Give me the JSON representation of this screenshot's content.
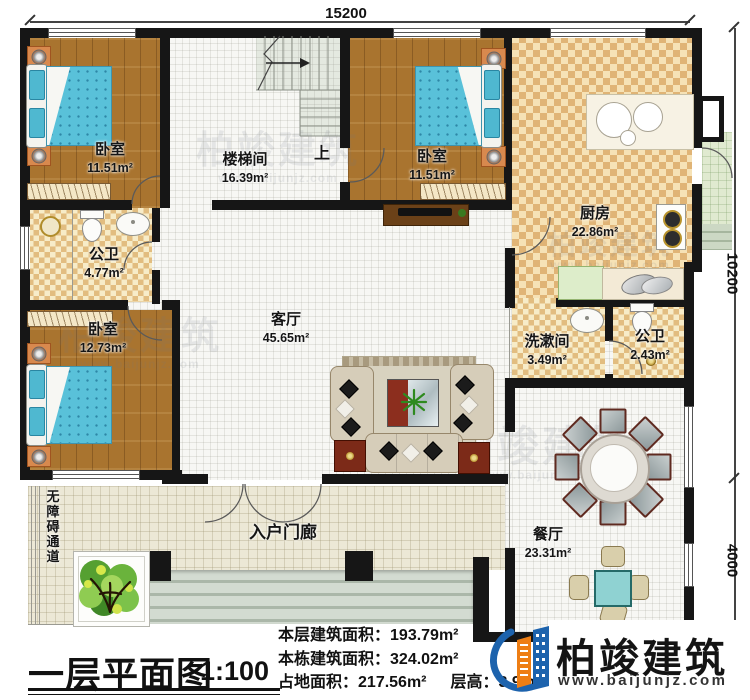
{
  "plan": {
    "title": "一层平面图",
    "scale": "1:100",
    "dims": {
      "top": "15200",
      "right_upper": "10200",
      "right_lower": "4000"
    },
    "labels": {
      "up": "上"
    }
  },
  "rooms": [
    {
      "name": "卧室",
      "area": "11.51m²"
    },
    {
      "name": "楼梯间",
      "area": "16.39m²"
    },
    {
      "name": "卧室",
      "area": "11.51m²"
    },
    {
      "name": "厨房",
      "area": "22.86m²"
    },
    {
      "name": "公卫",
      "area": "4.77m²"
    },
    {
      "name": "卧室",
      "area": "12.73m²"
    },
    {
      "name": "客厅",
      "area": "45.65m²"
    },
    {
      "name": "洗漱间",
      "area": "3.49m²"
    },
    {
      "name": "公卫",
      "area": "2.43m²"
    },
    {
      "name": "餐厅",
      "area": "23.31m²"
    },
    {
      "name": "入户门廊",
      "area": ""
    },
    {
      "name": "无障碍通道",
      "area": ""
    }
  ],
  "stats": {
    "line1": {
      "label": "本层建筑面积：",
      "value": "193.79m²"
    },
    "line2": {
      "label": "本栋建筑面积：",
      "value": "324.02m²"
    },
    "line3": {
      "label": "占地面积：",
      "value": "217.56m²"
    },
    "line4": {
      "label": "层高：",
      "value": "3.9m"
    }
  },
  "brand": {
    "name": "柏竣建筑",
    "website": "www.baijunjz.com"
  },
  "watermark": {
    "text": "柏竣建筑",
    "website": "www.baijunjz.com"
  },
  "colors": {
    "wall": "#161616",
    "wood_floor": "#a9742f",
    "kitchen_tile": "#e0b476",
    "brand_blue": "#1d63ad",
    "brand_orange": "#ee7e14",
    "bed_teal": "#59c1d9"
  }
}
